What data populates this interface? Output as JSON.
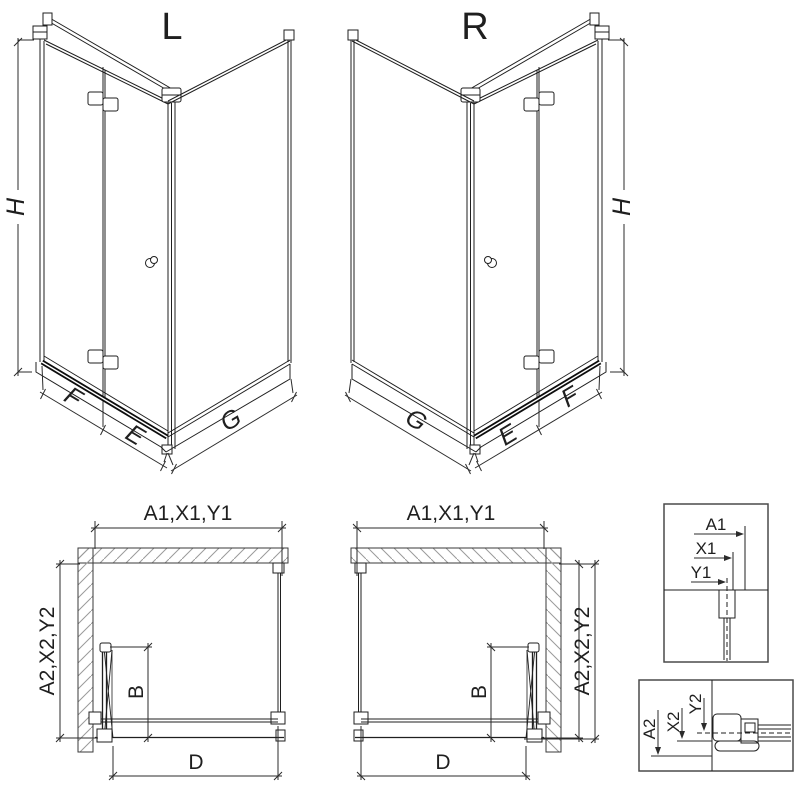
{
  "drawing": {
    "variant_left": {
      "title": "L"
    },
    "variant_right": {
      "title": "R"
    },
    "dims_3d": {
      "height": "H",
      "door_leaf": "F",
      "front": "E",
      "side": "G"
    },
    "dims_plan": {
      "width_codes": "A1,X1,Y1",
      "depth_codes": "A2,X2,Y2",
      "fold_depth": "B",
      "entry": "D"
    },
    "detail_top": {
      "a1": "A1",
      "x1": "X1",
      "y1": "Y1"
    },
    "detail_bottom": {
      "a2": "A2",
      "x2": "X2",
      "y2": "Y2"
    },
    "colors": {
      "line": "#1f1f1f",
      "dimension": "#2b2b2b",
      "hatch": "#9a9a9a",
      "background": "#ffffff"
    }
  }
}
